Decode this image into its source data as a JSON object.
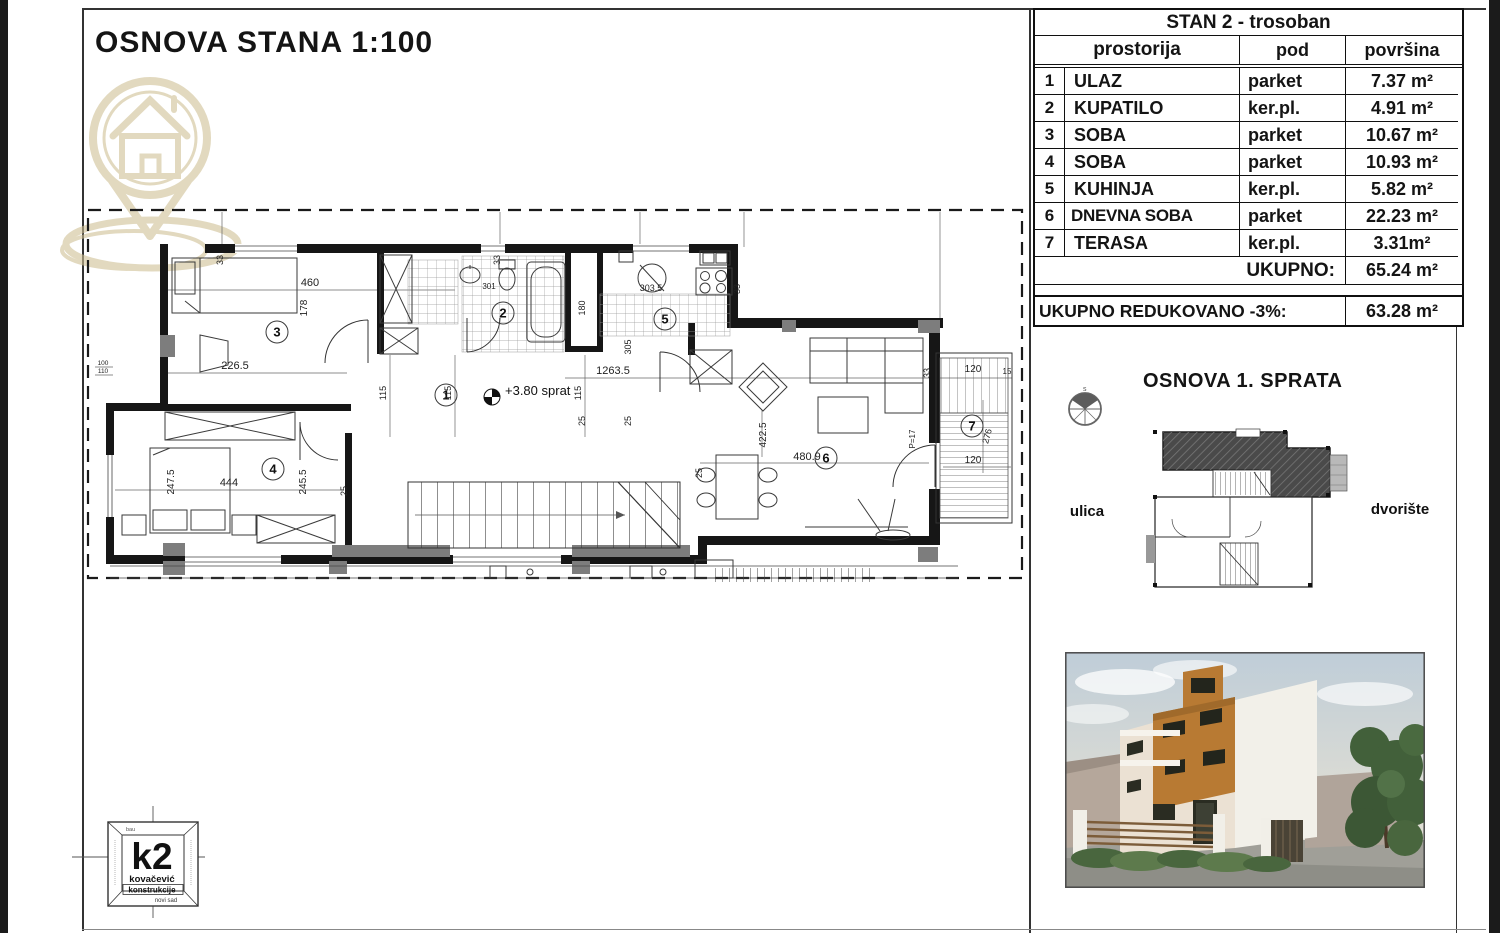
{
  "frame": {
    "title": "OSNOVA STANA 1:100"
  },
  "plan": {
    "level_label": "+3.80 sprat",
    "rooms": [
      "1",
      "2",
      "3",
      "4",
      "5",
      "6",
      "7"
    ],
    "dims": {
      "d460": "460",
      "d178": "178",
      "d226_5": "226.5",
      "d1263_5": "1263.5",
      "d303_5": "303.5",
      "d301": "301",
      "d305": "305",
      "d180": "180",
      "d115": "115",
      "d444": "444",
      "d247_5": "247.5",
      "d245_5": "245.5",
      "d25": "25",
      "d33": "33",
      "d480_9": "480.9",
      "d422_5": "422.5",
      "dP17": "P=17",
      "d120": "120",
      "d15": "15",
      "d276": "276",
      "d100": "100",
      "d110": "110"
    }
  },
  "table": {
    "title": "STAN 2 - trosoban",
    "col_room": "prostorija",
    "col_floor": "pod",
    "col_area": "površina",
    "rows": [
      {
        "num": "1",
        "name": "ULAZ",
        "floor": "parket",
        "area": "7.37 m²"
      },
      {
        "num": "2",
        "name": "KUPATILO",
        "floor": "ker.pl.",
        "area": "4.91 m²"
      },
      {
        "num": "3",
        "name": "SOBA",
        "floor": "parket",
        "area": "10.67 m²"
      },
      {
        "num": "4",
        "name": "SOBA",
        "floor": "parket",
        "area": "10.93 m²"
      },
      {
        "num": "5",
        "name": "KUHINJA",
        "floor": "ker.pl.",
        "area": "5.82 m²"
      },
      {
        "num": "6",
        "name": "DNEVNA SOBA",
        "floor": "parket",
        "area": "22.23 m²"
      },
      {
        "num": "7",
        "name": "TERASA",
        "floor": "ker.pl.",
        "area": "3.31m²"
      }
    ],
    "total_label": "UKUPNO:",
    "total_value": "65.24 m²",
    "reduced_label": "UKUPNO REDUKOVANO -3%:",
    "reduced_value": "63.28 m²"
  },
  "side": {
    "title": "OSNOVA 1. SPRATA",
    "left_label": "ulica",
    "right_label": "dvorište",
    "compass_letter": "s"
  },
  "logo": {
    "main": "k2",
    "line1": "kovačević",
    "line2": "konstrukcije",
    "city": "novi sad",
    "top": "bau"
  }
}
